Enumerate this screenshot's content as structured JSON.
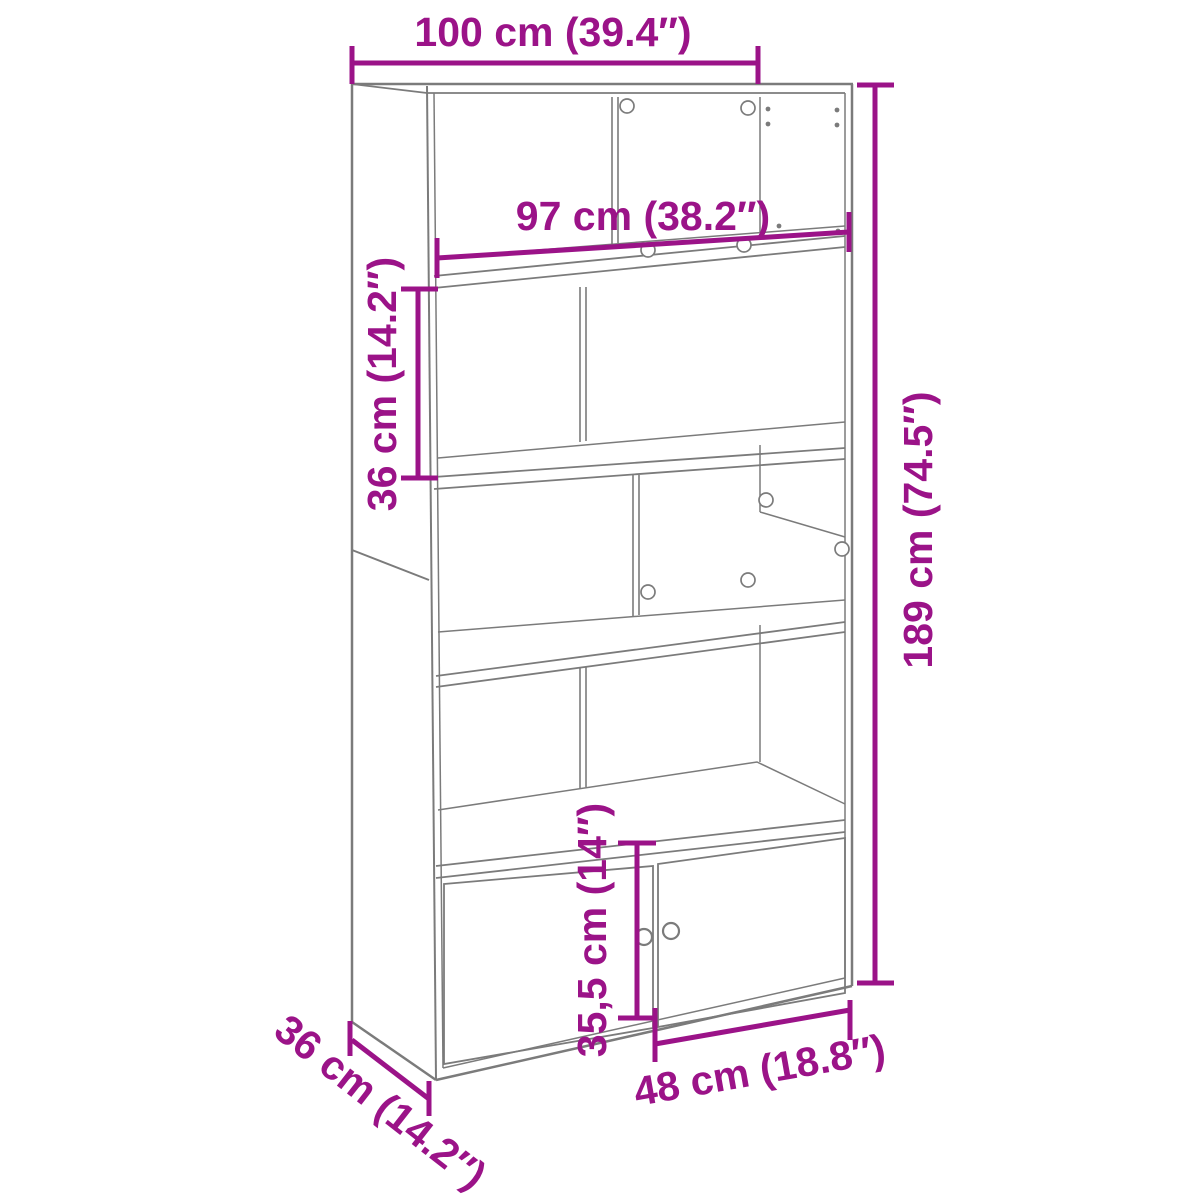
{
  "title": "Bookcase dimension diagram",
  "product": "bookcase with lower double doors",
  "colors": {
    "accent": "#9B1388",
    "line": "#7b7b7b",
    "background": "#ffffff"
  },
  "annotations": {
    "overall_width": "100 cm (39.4″)",
    "inner_width": "97 cm (38.2″)",
    "compartment_height": "36 cm (14.2″)",
    "overall_height": "189 cm (74.5″)",
    "door_height": "35,5 cm (14″)",
    "door_width": "48 cm (18.8″)",
    "depth": "36 cm (14.2″)"
  }
}
